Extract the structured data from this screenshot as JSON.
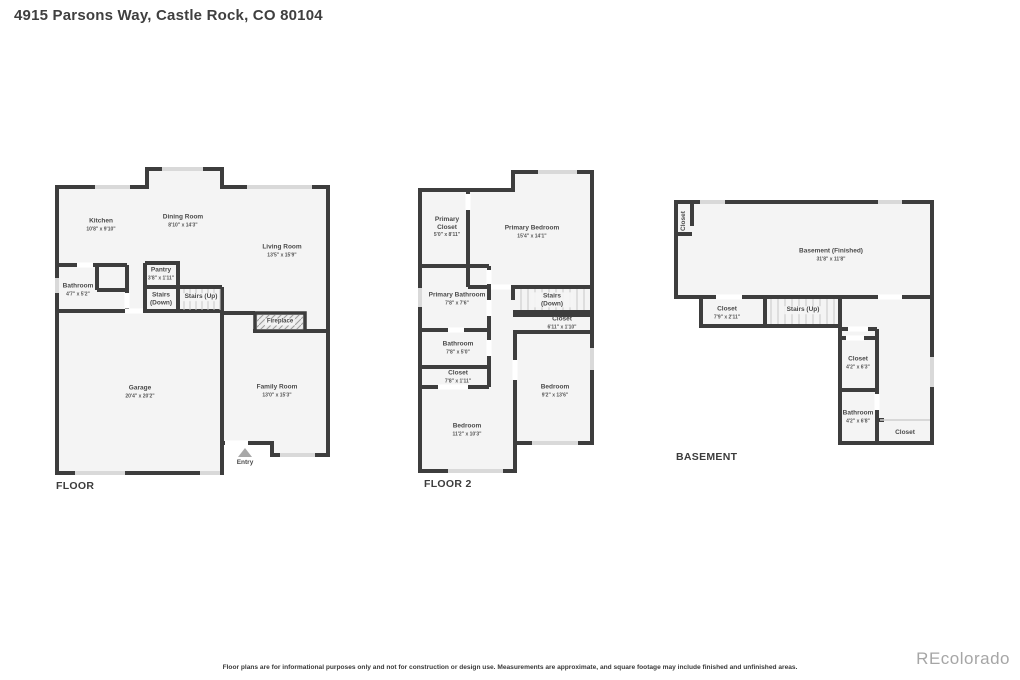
{
  "title": "4915 Parsons Way, Castle Rock, CO 80104",
  "floors": [
    {
      "label": "FLOOR",
      "rooms": [
        {
          "name": "Kitchen",
          "dims": "10'8\" x 9'10\""
        },
        {
          "name": "Dining Room",
          "dims": "8'10\" x 14'3\""
        },
        {
          "name": "Living Room",
          "dims": "13'5\" x 15'9\""
        },
        {
          "name": "Bathroom",
          "dims": "4'7\" x 5'2\""
        },
        {
          "name": "Pantry",
          "dims": "3'8\" x 1'11\""
        },
        {
          "name": "Stairs (Down)"
        },
        {
          "name": "Stairs (Up)"
        },
        {
          "name": "Fireplace"
        },
        {
          "name": "Garage",
          "dims": "20'4\" x 20'2\""
        },
        {
          "name": "Family Room",
          "dims": "13'0\" x 15'3\""
        },
        {
          "name": "Entry"
        }
      ]
    },
    {
      "label": "FLOOR 2",
      "rooms": [
        {
          "name": "Primary Closet",
          "dims": "5'0\" x 8'11\""
        },
        {
          "name": "Primary Bedroom",
          "dims": "15'4\" x 14'1\""
        },
        {
          "name": "Primary Bathroom",
          "dims": "7'8\" x 7'6\""
        },
        {
          "name": "Stairs (Down)"
        },
        {
          "name": "Closet",
          "dims": "6'11\" x 1'10\""
        },
        {
          "name": "Bathroom",
          "dims": "7'8\" x 5'0\""
        },
        {
          "name": "Closet",
          "dims": "7'8\" x 1'11\""
        },
        {
          "name": "Bedroom",
          "dims": "9'2\" x 13'6\""
        },
        {
          "name": "Bedroom",
          "dims": "11'2\" x 10'3\""
        }
      ]
    },
    {
      "label": "BASEMENT",
      "rooms": [
        {
          "name": "Closet"
        },
        {
          "name": "Basement (Finished)",
          "dims": "31'8\" x 11'8\""
        },
        {
          "name": "Closet",
          "dims": "7'9\" x 2'11\""
        },
        {
          "name": "Stairs (Up)"
        },
        {
          "name": "Closet",
          "dims": "4'2\" x 6'3\""
        },
        {
          "name": "Bathroom",
          "dims": "4'2\" x 6'8\""
        },
        {
          "name": "Closet"
        }
      ]
    }
  ],
  "footer": {
    "disclaimer": "Floor plans are for informational purposes only and not for construction or design use. Measurements are approximate, and square footage may include finished and unfinished areas.",
    "watermark": "REcolorado"
  },
  "colors": {
    "wall": "#3d3d3d",
    "room_fill": "#f4f4f4",
    "window": "#d9d9d9",
    "stair_tread": "#c9c9c9",
    "label_text": "#4a4a4a",
    "watermark": "#a6a6a6"
  }
}
